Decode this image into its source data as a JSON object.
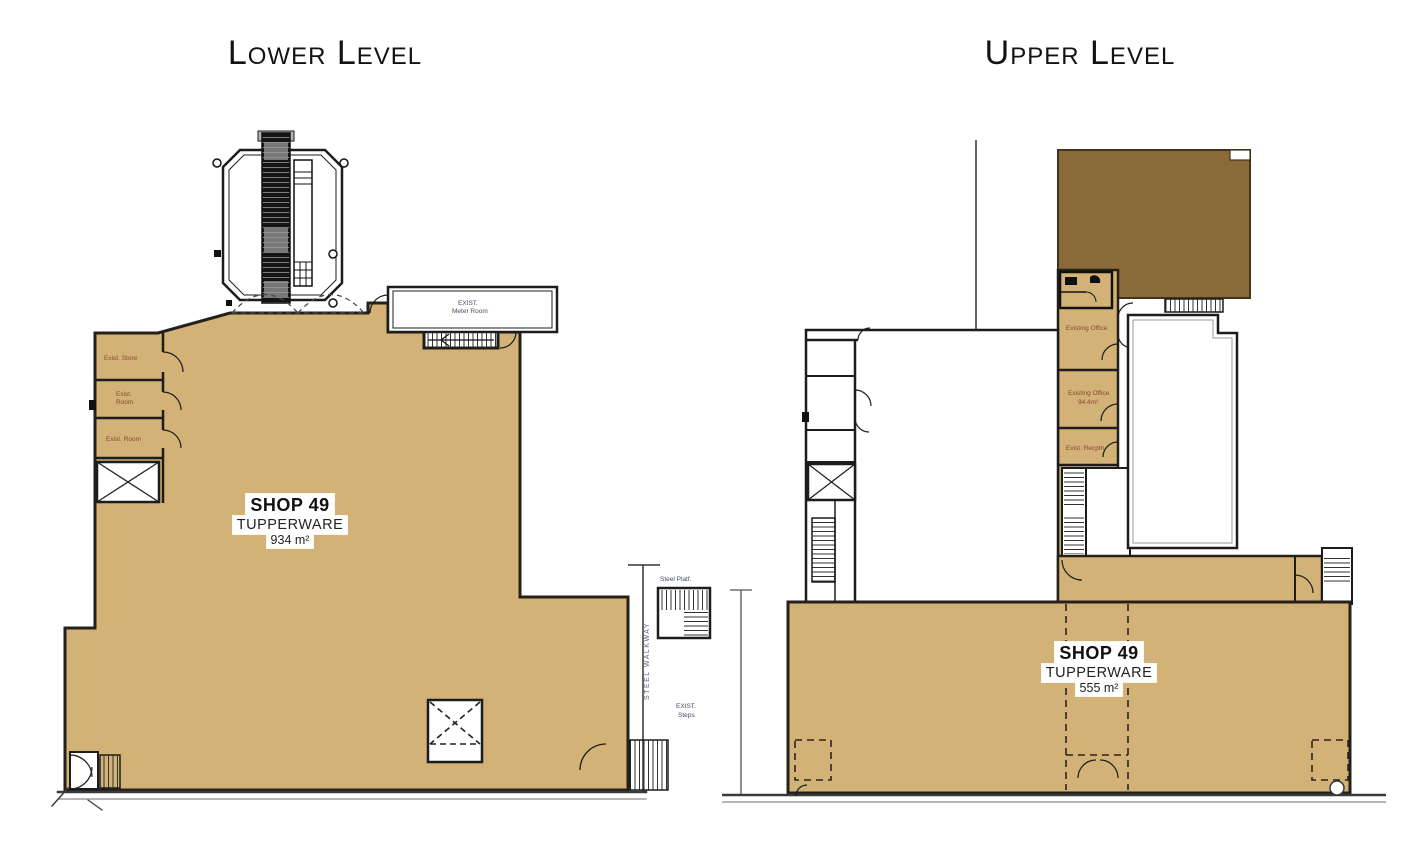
{
  "document_type": "shop-floor-plan",
  "lower": {
    "title": "Lower Level",
    "shop": {
      "name": "SHOP 49",
      "tenant": "TUPPERWARE",
      "area": "934 m²"
    },
    "rooms": {
      "meter_room_line1": "EXIST.",
      "meter_room_line2": "Meter Room",
      "exist_store": "Exist. Store",
      "exist_room_small_line1": "Exist.",
      "exist_room_small_line2": "Room",
      "exist_room": "Exist. Room",
      "steel_platform": "Steel Platf.",
      "steel_walkway": "STEEL WALKWAY",
      "exist_steps_line1": "EXIST.",
      "exist_steps_line2": "Steps"
    }
  },
  "upper": {
    "title": "Upper Level",
    "shop": {
      "name": "SHOP 49",
      "tenant": "TUPPERWARE",
      "area": "555 m²"
    },
    "rooms": {
      "existing_office": "Existing Office",
      "existing_office2_line1": "Existing Office",
      "existing_office2_line2": "94.4m²",
      "exist_recptn": "Exist. Recptn"
    }
  },
  "colors": {
    "shop_fill": "#d2b276",
    "dark_area_fill": "#8a6a39",
    "wall": "#26201a",
    "room_label": "#8a4534",
    "annotation_blue": "#454a68"
  }
}
